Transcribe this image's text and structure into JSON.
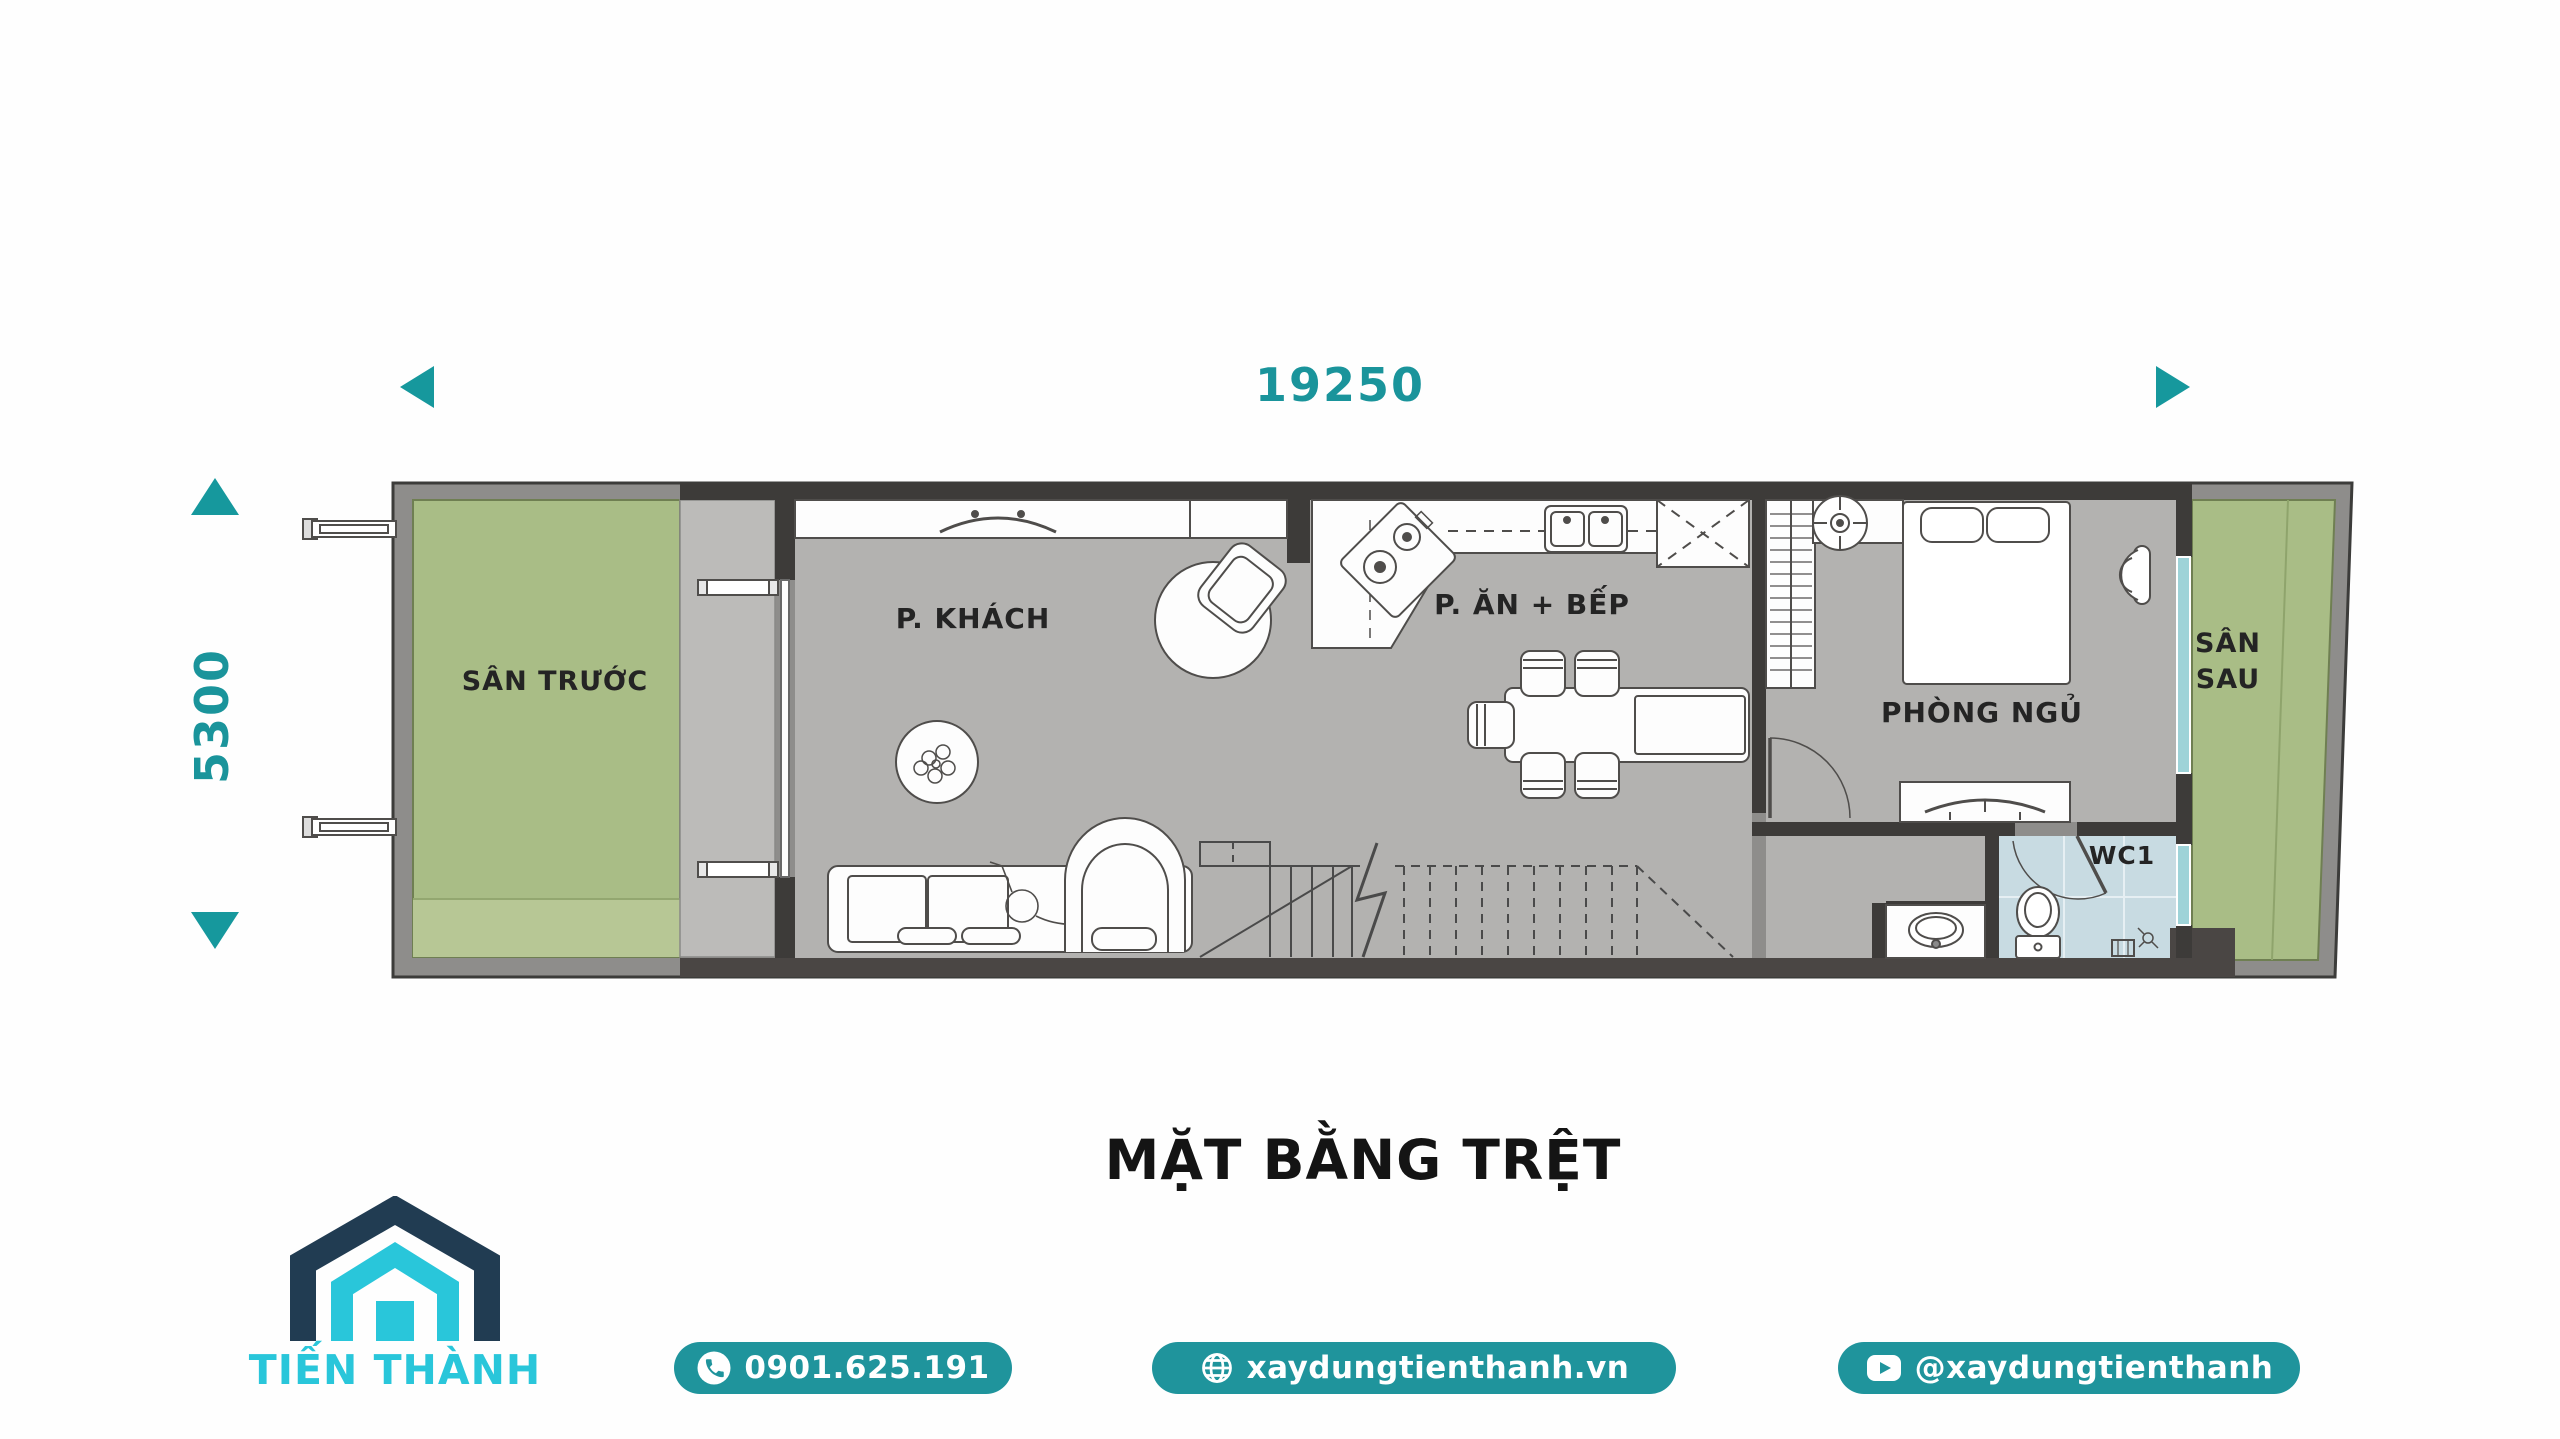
{
  "title": "MẶT BẰNG TRỆT",
  "dimensions": {
    "width_label": "19250",
    "height_label": "5300"
  },
  "rooms": {
    "front_yard": "SÂN TRƯỚC",
    "living": "P. KHÁCH",
    "kitchen": "P. ĂN + BẾP",
    "bedroom": "PHÒNG NGỦ",
    "wc": "WC1",
    "back_yard_line1": "SÂN",
    "back_yard_line2": "SAU"
  },
  "brand": {
    "name": "TIẾN THÀNH"
  },
  "footer": {
    "phone": "0901.625.191",
    "website": "xaydungtienthanh.vn",
    "social": "@xaydungtienthanh"
  },
  "colors": {
    "accent_teal": "#1a949b",
    "button_teal": "#1f949c",
    "logo_navy": "#213c52",
    "logo_cyan": "#29c6da",
    "yard_green": "#a9bd86",
    "floor_gray": "#b3b2b0",
    "wall_gray": "#8e8d8b",
    "wall_dark": "#3d3b39",
    "wc_blue": "#c8dbe2",
    "window_teal": "#9ed3d8"
  }
}
